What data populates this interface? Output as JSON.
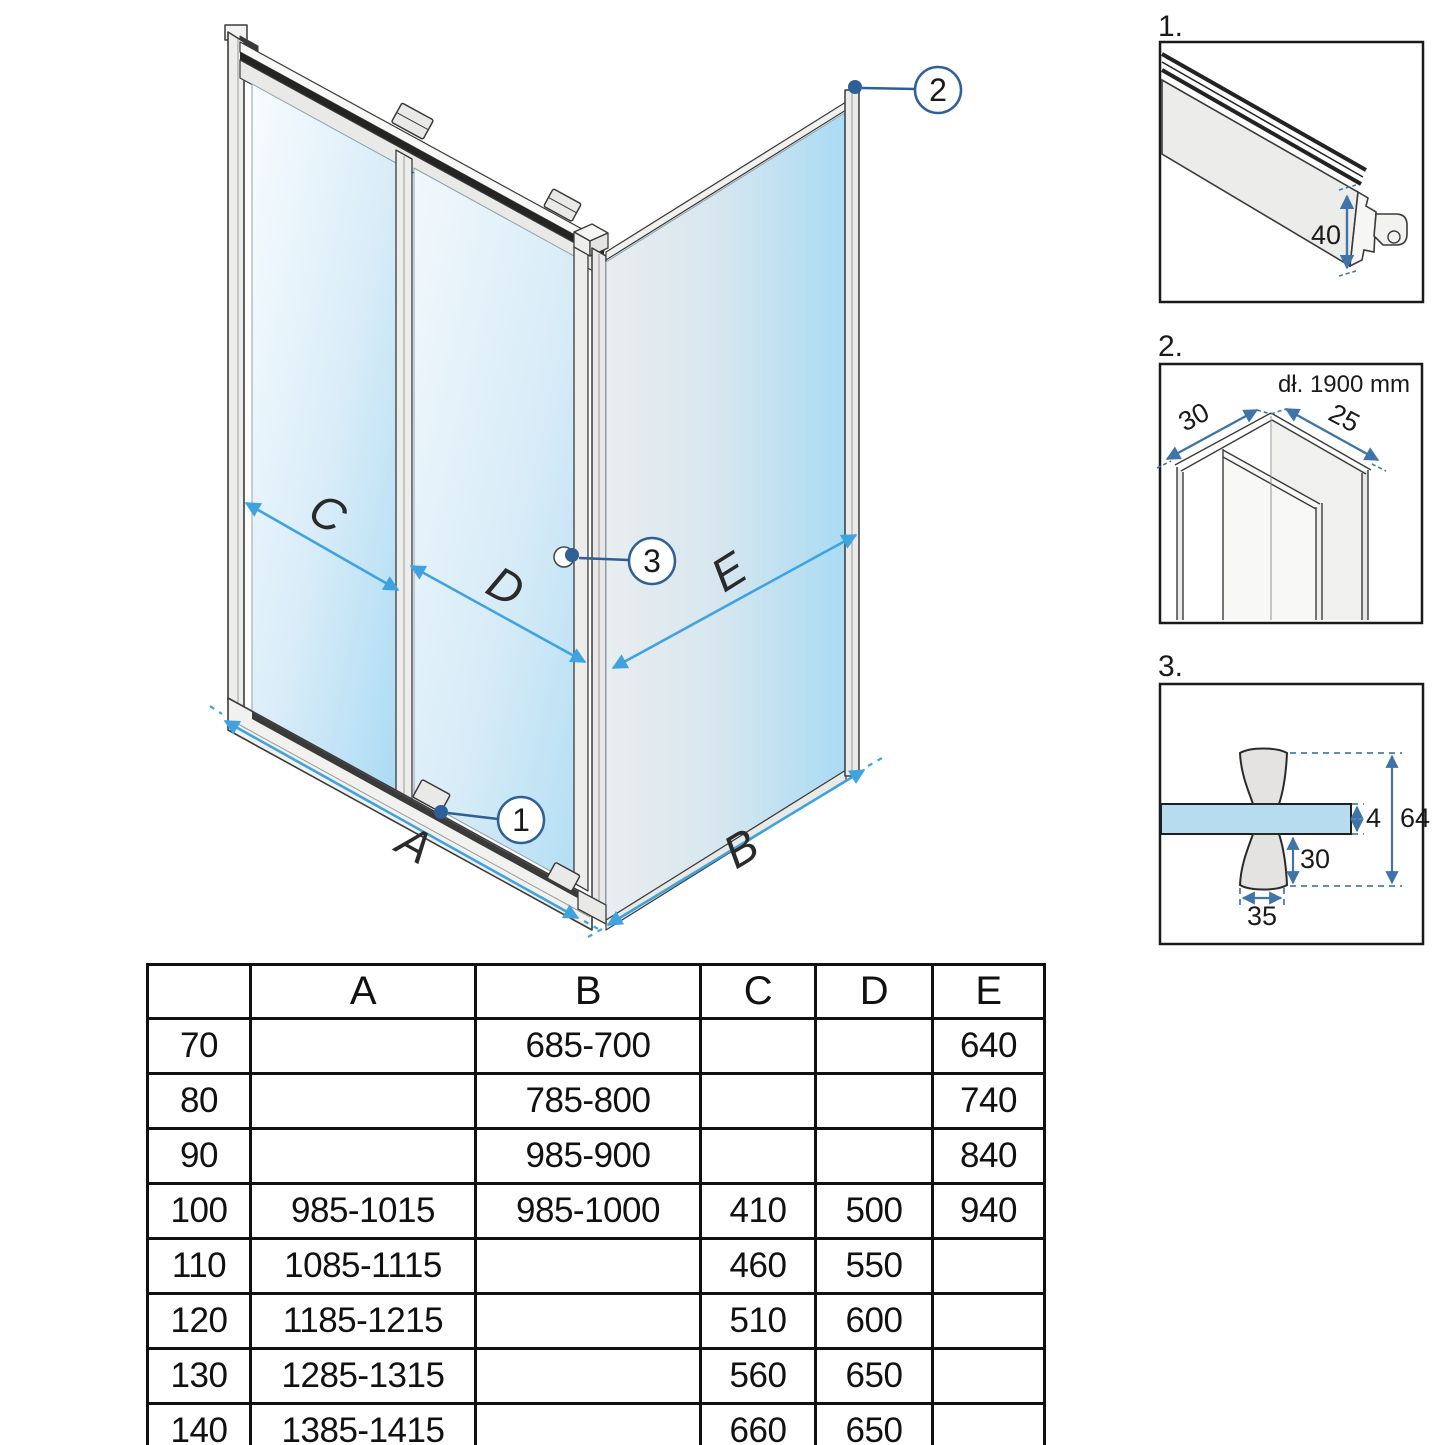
{
  "main_diagram": {
    "dim_labels": {
      "a": "A",
      "b": "B",
      "c": "C",
      "d": "D",
      "e": "E"
    },
    "callouts": {
      "c1": "1",
      "c2": "2",
      "c3": "3"
    }
  },
  "details": {
    "d1": {
      "label": "1.",
      "height_dim": "40"
    },
    "d2": {
      "label": "2.",
      "length_note": "dł. 1900 mm",
      "left_dim": "30",
      "right_dim": "25"
    },
    "d3": {
      "label": "3.",
      "glass_thickness": "4",
      "total_height": "64",
      "knob_height": "30",
      "knob_width": "35"
    }
  },
  "table": {
    "headers": [
      "",
      "A",
      "B",
      "C",
      "D",
      "E"
    ],
    "rows": [
      [
        "70",
        "",
        "685-700",
        "",
        "",
        "640"
      ],
      [
        "80",
        "",
        "785-800",
        "",
        "",
        "740"
      ],
      [
        "90",
        "",
        "985-900",
        "",
        "",
        "840"
      ],
      [
        "100",
        "985-1015",
        "985-1000",
        "410",
        "500",
        "940"
      ],
      [
        "110",
        "1085-1115",
        "",
        "460",
        "550",
        ""
      ],
      [
        "120",
        "1185-1215",
        "",
        "510",
        "600",
        ""
      ],
      [
        "130",
        "1285-1315",
        "",
        "560",
        "650",
        ""
      ],
      [
        "140",
        "1385-1415",
        "",
        "660",
        "650",
        ""
      ]
    ]
  },
  "colors": {
    "dimension_arrow_blue": "#3fa3e0",
    "callout_blue": "#2e5f96",
    "detail_dim_blue": "#3f74a8",
    "glass_blue": "#aedcf4",
    "frame_gray": "#ececea"
  }
}
